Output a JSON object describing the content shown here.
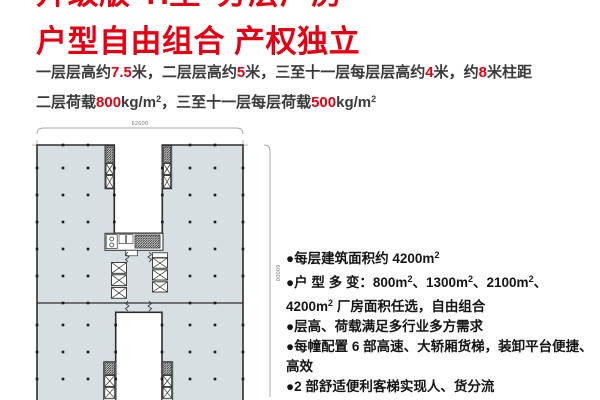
{
  "heading": {
    "line1": "升级版“H型”分层厂房",
    "line2": "户型自由组合 产权独立"
  },
  "specs": {
    "line1": [
      {
        "t": "一层层高约"
      },
      {
        "t": "7.5",
        "red": true
      },
      {
        "t": "米，二层层高约"
      },
      {
        "t": "5",
        "red": true
      },
      {
        "t": "米，三至十一层每层层高约"
      },
      {
        "t": "4",
        "red": true
      },
      {
        "t": "米，约"
      },
      {
        "t": "8",
        "red": true
      },
      {
        "t": "米柱距"
      }
    ],
    "line2": [
      {
        "t": "二层荷载"
      },
      {
        "t": "800",
        "red": true
      },
      {
        "t": "kg/m"
      },
      {
        "t": "2",
        "sup": true
      },
      {
        "t": "，三至十一层每层荷载"
      },
      {
        "t": "500",
        "red": true
      },
      {
        "t": "kg/m"
      },
      {
        "t": "2",
        "sup": true
      }
    ]
  },
  "floor_plan": {
    "width_label": "62600",
    "height_label": "60000"
  },
  "features": [
    {
      "lines": [
        [
          {
            "t": "●每层建筑面积约 4200m"
          },
          {
            "t": "2",
            "sup": true
          }
        ]
      ]
    },
    {
      "lines": [
        [
          {
            "t": "●户 型 多 变：800m"
          },
          {
            "t": "2",
            "sup": true
          },
          {
            "t": "、1300m"
          },
          {
            "t": "2",
            "sup": true
          },
          {
            "t": "、2100m"
          },
          {
            "t": "2",
            "sup": true
          },
          {
            "t": "、"
          }
        ],
        [
          {
            "t": "4200m"
          },
          {
            "t": "2",
            "sup": true
          },
          {
            "t": " 厂房面积任选，自由组合"
          }
        ]
      ]
    },
    {
      "lines": [
        [
          {
            "t": "●层高、荷载满足多行业多方需求"
          }
        ]
      ]
    },
    {
      "lines": [
        [
          {
            "t": "●每幢配置 6 部高速、大轿厢货梯，装卸平台便捷、"
          }
        ],
        [
          {
            "t": "高效"
          }
        ]
      ]
    },
    {
      "lines": [
        [
          {
            "t": "●2 部舒适便利客梯实现人、货分流"
          }
        ]
      ]
    }
  ],
  "colors": {
    "accent_red": "#e60012",
    "plan_fill": "#d8dfe3",
    "plan_stroke": "#2e2e2e",
    "body_text": "#3a3a3a"
  }
}
